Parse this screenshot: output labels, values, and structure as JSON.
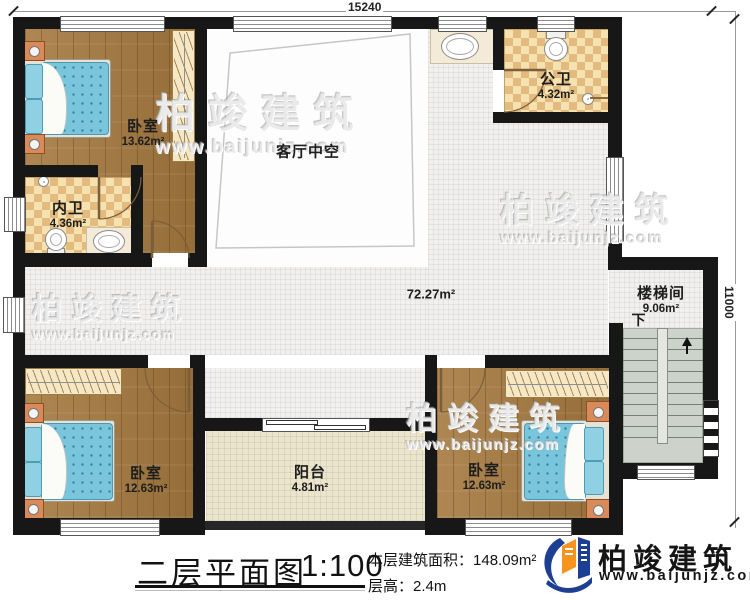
{
  "plan": {
    "dim_top": "15240",
    "dim_right": "11000",
    "rooms": {
      "bedroom_tl": {
        "name": "卧室",
        "area": "13.62m²"
      },
      "inner_bath": {
        "name": "内卫",
        "area": "4.36m²"
      },
      "living_void": {
        "name": "客厅中空"
      },
      "public_bath": {
        "name": "公卫",
        "area": "4.32m²"
      },
      "hallway": {
        "area": "72.27m²"
      },
      "stairwell": {
        "name": "楼梯间",
        "area": "9.06m²",
        "down_label": "下"
      },
      "bedroom_bl": {
        "name": "卧室",
        "area": "12.63m²"
      },
      "balcony": {
        "name": "阳台",
        "area": "4.81m²"
      },
      "bedroom_br": {
        "name": "卧室",
        "area": "12.63m²"
      }
    }
  },
  "title_block": {
    "title": "二层平面图",
    "scale": "1:100",
    "floor_area_label": "本层建筑面积：",
    "floor_area_value": "148.09m²",
    "floor_height_label": "层高：",
    "floor_height_value": "2.4m"
  },
  "branding": {
    "company": "柏竣建筑",
    "website": "www.baijunjz.com"
  },
  "watermark": {
    "company": "柏竣建筑",
    "website": "www.baijunjz.com"
  },
  "colors": {
    "wall": "#171717",
    "wood_floor": "#a5793f",
    "tile_floor": "#f1f0ee",
    "bath_checker": "#e3bb7e",
    "balcony_floor": "#ece5cd",
    "stair_floor": "#cdd3ca",
    "bed": "#79c6dc",
    "logo_blue": "#1c3f94",
    "logo_orange": "#f7941d"
  }
}
